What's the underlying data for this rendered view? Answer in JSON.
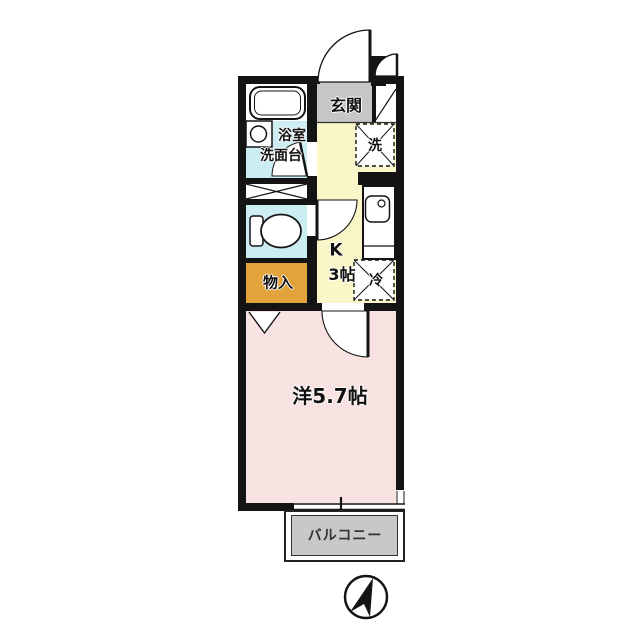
{
  "rooms": {
    "entrance": {
      "label": "玄関"
    },
    "bathroom": {
      "label_line1": "浴室",
      "label_line2": "洗面台"
    },
    "washing_machine": {
      "label": "洗"
    },
    "kitchen": {
      "label_line1": "K",
      "label_line2": "3帖"
    },
    "refrigerator": {
      "label": "冷"
    },
    "storage": {
      "label": "物入"
    },
    "western_room": {
      "label": "洋5.7帖"
    },
    "balcony": {
      "label": "バルコニー"
    }
  },
  "colors": {
    "wet_area_floor": "#cceef2",
    "kitchen_floor": "#f9f6c8",
    "storage_floor": "#e2a33b",
    "western_room_floor": "#f8e2e2",
    "entrance_floor": "#c6c6c6",
    "balcony_floor": "#c8c8c8",
    "wall": "#141414"
  }
}
